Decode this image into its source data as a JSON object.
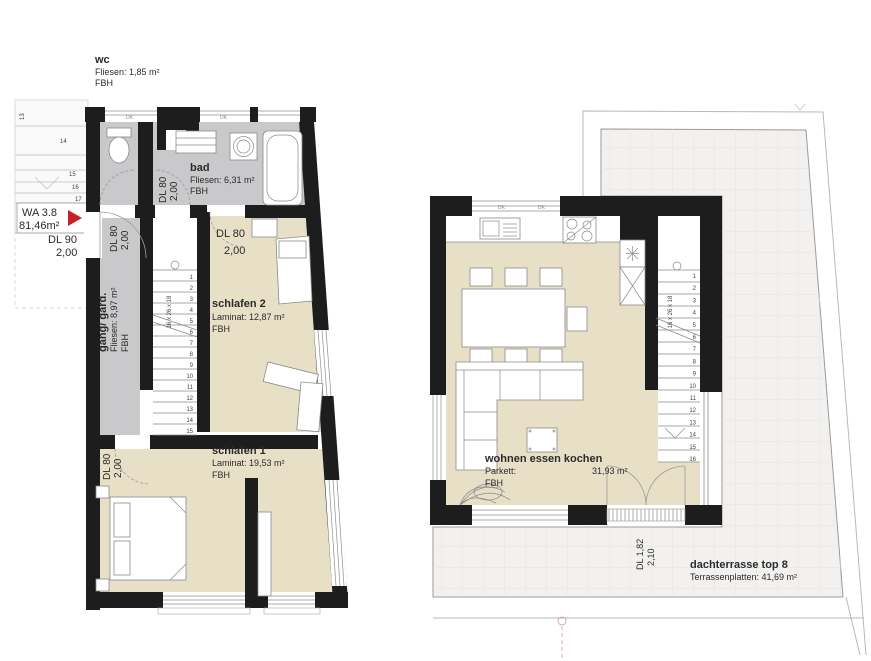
{
  "unit": {
    "id": "WA 3.8",
    "area": "81,46m²"
  },
  "window_label": "DK",
  "colors": {
    "wall": "#1d1d1d",
    "tile_floor": "#c9c9cb",
    "wood_floor": "#e8dfc7",
    "terrace_floor": "#f2f1f0",
    "accent_red": "#c8202a"
  },
  "lower_plan": {
    "wc": {
      "name": "wc",
      "floor": "Fliesen: 1,85 m²",
      "heating": "FBH"
    },
    "bad": {
      "name": "bad",
      "floor": "Fliesen: 6,31 m²",
      "heating": "FBH"
    },
    "gang": {
      "name": "gang/ gard.",
      "floor": "Fliesen: 8,97 m²",
      "heating": "FBH"
    },
    "schlafen2": {
      "name": "schlafen 2",
      "floor": "Laminat: 12,87 m²",
      "heating": "FBH"
    },
    "schlafen1": {
      "name": "schlafen 1",
      "floor": "Laminat: 19,53 m²",
      "heating": "FBH"
    },
    "entry_door": {
      "label": "DL  90",
      "height": "2,00"
    },
    "door_80": {
      "label": "DL 80",
      "height": "2,00"
    },
    "stairs": {
      "dim": "16 x 26 x 18",
      "first": 1,
      "last": 15
    },
    "exterior_steps": [
      "13",
      "14",
      "15",
      "16",
      "17"
    ]
  },
  "upper_plan": {
    "wohnen": {
      "name": "wohnen essen kochen",
      "floor_type": "Parkett:",
      "area": "31,93 m²",
      "heating": "FBH"
    },
    "terrace": {
      "name": "dachterrasse top 8",
      "floor": "Terrassenplatten: 41,69 m²"
    },
    "terrace_door": {
      "label": "DL 1,82",
      "height": "2,10"
    },
    "stairs": {
      "dim": "16 x 26 x 18",
      "first": 1,
      "last": 16
    }
  }
}
